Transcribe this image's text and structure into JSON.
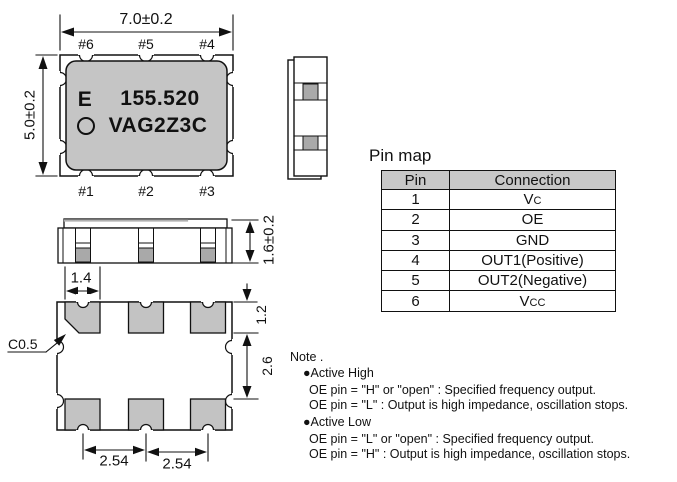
{
  "colors": {
    "body_gray": "#c5c5c5",
    "pad_gray": "#c3c3c3",
    "metal_gray": "#a9a9a9",
    "table_header_gray": "#c8c8c8",
    "line_black": "#111111"
  },
  "top_view": {
    "width_dim": "7.0±0.2",
    "height_dim": "5.0±0.2",
    "pins_top": [
      "#6",
      "#5",
      "#4"
    ],
    "pins_bottom": [
      "#1",
      "#2",
      "#3"
    ],
    "marking": {
      "vendor_letter": "E",
      "frequency": "155.520",
      "part_code": "VAG2Z3C"
    }
  },
  "front_view": {
    "height_dim": "1.6±0.2",
    "pad_width_dim": "1.4"
  },
  "bottom_view": {
    "chamfer_label": "C0.5",
    "pad_height_dim": "1.2",
    "pad_gap_dim": "2.6",
    "pitch_dims": [
      "2.54",
      "2.54"
    ]
  },
  "pin_map": {
    "title": "Pin map",
    "headers": {
      "pin": "Pin",
      "connection": "Connection"
    },
    "rows": [
      {
        "pin": "1",
        "connection": "Vc"
      },
      {
        "pin": "2",
        "connection": "OE"
      },
      {
        "pin": "3",
        "connection": "GND"
      },
      {
        "pin": "4",
        "connection": "OUT1(Positive)"
      },
      {
        "pin": "5",
        "connection": "OUT2(Negative)"
      },
      {
        "pin": "6",
        "connection": "Vcc"
      }
    ]
  },
  "note": {
    "title": "Note .",
    "sections": [
      {
        "heading": "●Active High",
        "lines": [
          "OE pin = \"H\" or \"open\" : Specified frequency output.",
          "OE pin = \"L\" : Output is high impedance, oscillation stops."
        ]
      },
      {
        "heading": "●Active Low",
        "lines": [
          "OE pin = \"L\" or \"open\" : Specified frequency output.",
          "OE pin = \"H\" : Output is high impedance, oscillation stops."
        ]
      }
    ]
  }
}
